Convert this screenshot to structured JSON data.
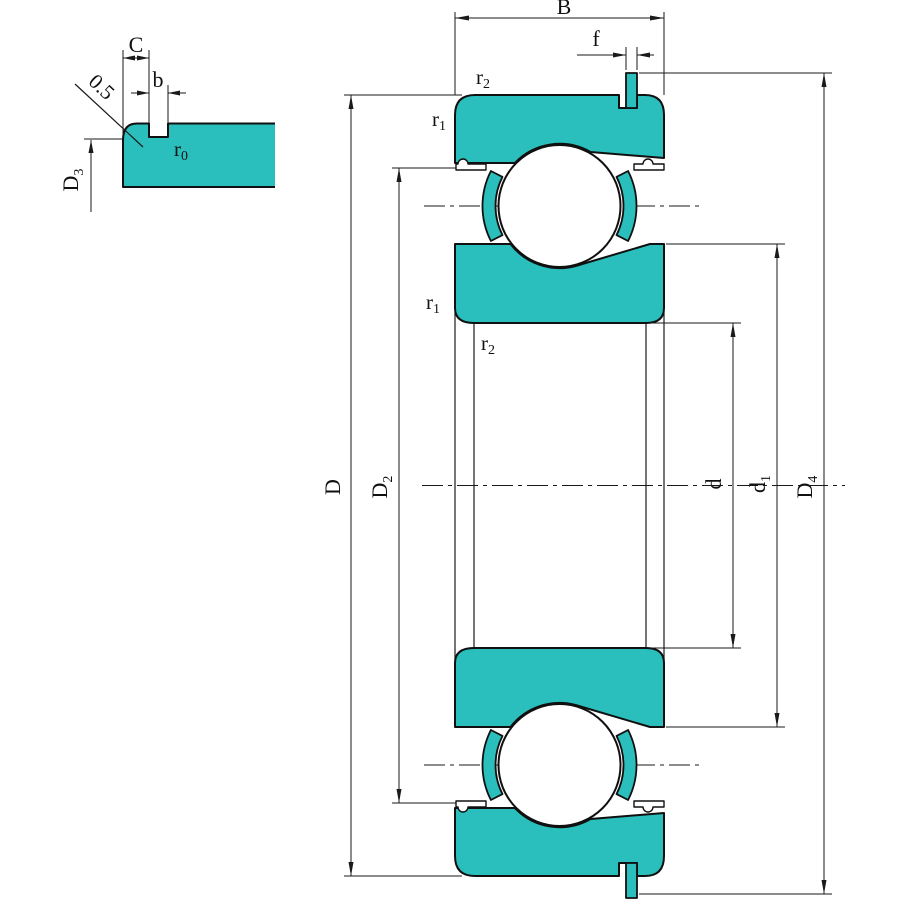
{
  "drawing": {
    "colors": {
      "section_fill": "#2abfbc",
      "line": "#1a1a1a"
    },
    "detail_view": {
      "dim_C": {
        "main": "C"
      },
      "dim_b": {
        "main": "b"
      },
      "chamfer": {
        "main": "0.5"
      },
      "radius_r0": {
        "main": "r",
        "sub": "0"
      },
      "dim_D3": {
        "main": "D",
        "sub": "3"
      }
    },
    "main_view": {
      "dim_B": {
        "main": "B"
      },
      "dim_f": {
        "main": "f"
      },
      "radius_r1": {
        "main": "r",
        "sub": "1"
      },
      "radius_r2": {
        "main": "r",
        "sub": "2"
      },
      "dim_D": {
        "main": "D"
      },
      "dim_D2": {
        "main": "D",
        "sub": "2"
      },
      "dim_D4": {
        "main": "D",
        "sub": "4"
      },
      "dim_d": {
        "main": "d"
      },
      "dim_d1": {
        "main": "d",
        "sub": "1"
      }
    }
  }
}
